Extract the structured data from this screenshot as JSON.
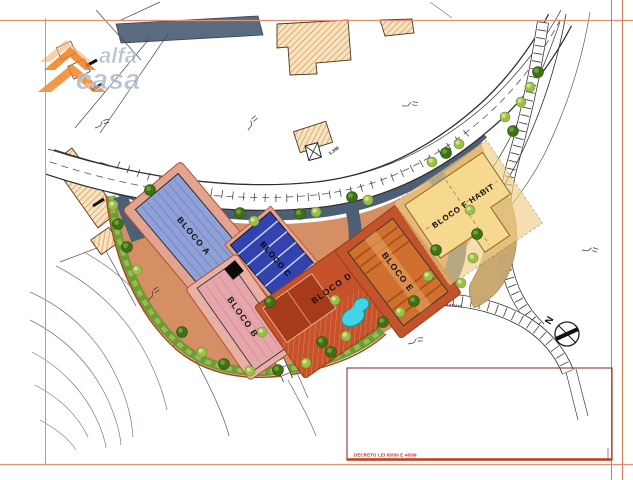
{
  "page": {
    "width": 633,
    "height": 480
  },
  "watermark": {
    "word1": "alfa",
    "word2": "casa",
    "text_color": "#9bb0c6",
    "roof_color": "#ef7d1d"
  },
  "site_plan": {
    "blocks": [
      {
        "key": "bloco_a",
        "label": "BLOCO A",
        "color": "#8fa1d6"
      },
      {
        "key": "bloco_b",
        "label": "BLOCO B",
        "color": "#e6a6ab"
      },
      {
        "key": "bloco_c",
        "label": "BLOCO C",
        "color": "#3242ae"
      },
      {
        "key": "bloco_d",
        "label": "BLOCO D",
        "color": "#c5522a"
      },
      {
        "key": "bloco_e",
        "label": "BLOCO E",
        "color": "#d1702e"
      },
      {
        "key": "bloco_f",
        "label": "BLOCO F HABIT",
        "color": "#f6d88e"
      }
    ],
    "road_label": "Travessa do Outeiro",
    "elevation_label": "1.349",
    "compass_label": "N",
    "pool_color": "#41d3e6",
    "parking_color": "#4c5f75",
    "landscape_color": "#6f9a35",
    "ground_color": "#d68e64",
    "court_color": "#a83a1c"
  },
  "title_block": {
    "note": "DECRETO LEI 65/99 E 46/99",
    "frame_color": "#d4825e",
    "accent_color": "#8b2218",
    "note_color": "#c0281a"
  }
}
